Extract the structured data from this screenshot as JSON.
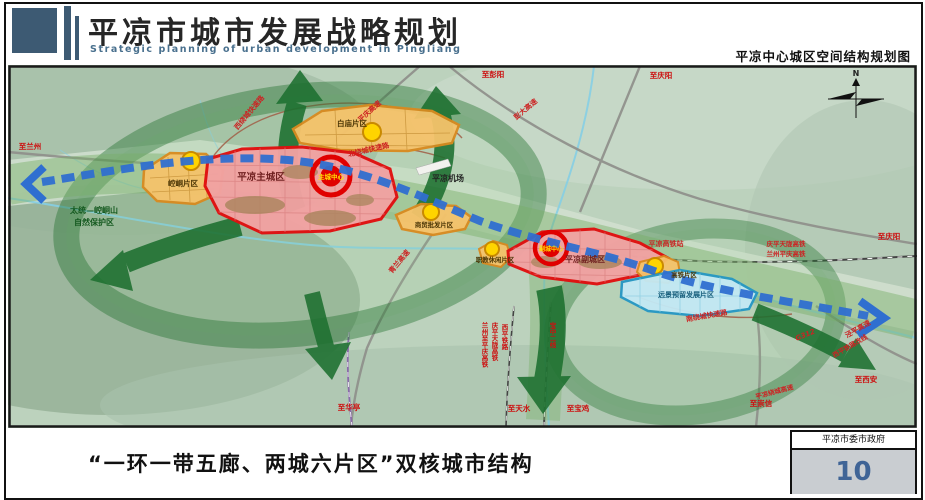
{
  "header": {
    "title": "平凉市城市发展战略规划",
    "subtitle": "Strategic planning of urban development in Pingliang",
    "right_caption": "平凉中心城区空间结构规划图"
  },
  "map": {
    "compass": "N",
    "zones": {
      "kongtong": "崆峒片区",
      "baimiao": "白庙片区",
      "main_city": "平凉主城区",
      "main_center": "主城中心",
      "shangmao": "商贸批发片区",
      "zhijiao": "职教休闲片区",
      "sub_city": "平凉副城区",
      "sub_center": "副城中心",
      "gaotie": "高铁片区",
      "reserve": "远景预留发展片区"
    },
    "poi": {
      "airport": "平凉机场",
      "hsr_station": "平凉高铁站",
      "nature_reserve_1": "太统—崆峒山",
      "nature_reserve_2": "自然保护区"
    },
    "roads": {
      "xi_ring": "西绕城快速路",
      "bei_ring": "北绕城快速路",
      "nan_ring": "南绕城快速路",
      "pingqing": "平庆高速",
      "pengda": "彭大高速",
      "qinglan": "青兰高速",
      "jingping": "泾平高速",
      "xiping_reroute": "西平铁路改线",
      "g312": "G312",
      "pl_ring_exp": "平凉绕城高速"
    },
    "rails": {
      "qingping_tianlong": "庆平天陇高铁",
      "lanzhou_pingqing": "兰州平庆高铁",
      "lanzhou_zhi_pingqing": "兰州至平庆高铁",
      "xiping": "西平铁路",
      "baozhong_2": "宝中二线"
    },
    "destinations": {
      "lanzhou": "至兰州",
      "pengyang": "至彭阳",
      "qingyang_top": "至庆阳",
      "qingyang_right": "至庆阳",
      "xian": "至西安",
      "chongxin": "至崇信",
      "baoji": "至宝鸡",
      "tianshui": "至天水",
      "huating": "至华亭"
    }
  },
  "footer": {
    "caption": "“一环一带五廊、两城六片区”双核城市结构",
    "organization": "平凉市委市政府",
    "page_number": "10"
  },
  "colors": {
    "header_accent": "#3d5a73",
    "map_background": "#bcd2bd",
    "corridor_green": "#1d7030",
    "axis_blue": "#2f6fd0",
    "city_red": "#e01010",
    "district_orange": "#d98a1f",
    "reserve_cyan": "#2597c4",
    "page_number_blue": "#3f6496"
  }
}
